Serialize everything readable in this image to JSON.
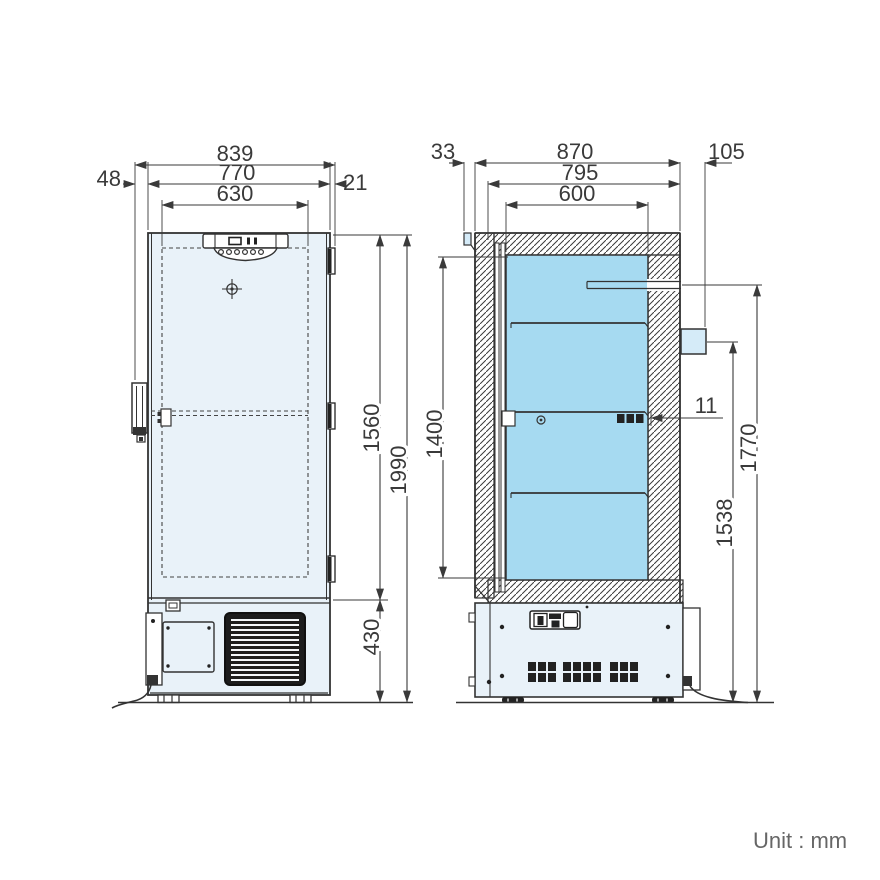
{
  "drawing": {
    "type": "dimensional-outline-drawing",
    "subject": "upright ultra-low temperature freezer, front view and side sectional view",
    "unit_label": "Unit : mm"
  },
  "front_view": {
    "name": "front exterior view",
    "width_dims": {
      "overall": "839",
      "body": "770",
      "inner": "630",
      "handle_left": "48",
      "hinge_right": "21"
    },
    "height_dims": {
      "upper_section": "1560",
      "overall": "1990",
      "base_section": "430"
    }
  },
  "side_view": {
    "name": "side sectional view",
    "depth_dims": {
      "handle": "33",
      "overall": "870",
      "body": "795",
      "chamber": "600",
      "rear_port": "105"
    },
    "height_dims": {
      "chamber": "1400",
      "upper_port": "1770",
      "lower_port": "1538",
      "shelf_gap": "11"
    },
    "features": [
      "3 interior shelves",
      "rear access port",
      "machine compartment with vents"
    ]
  },
  "colors": {
    "line": "#333333",
    "dimension_text": "#3a3a3a",
    "chamber_fill": "#a6daf1",
    "panel_fill": "#e9f2f9",
    "port_fill": "#d5ebf8",
    "unit_text": "#666666"
  }
}
